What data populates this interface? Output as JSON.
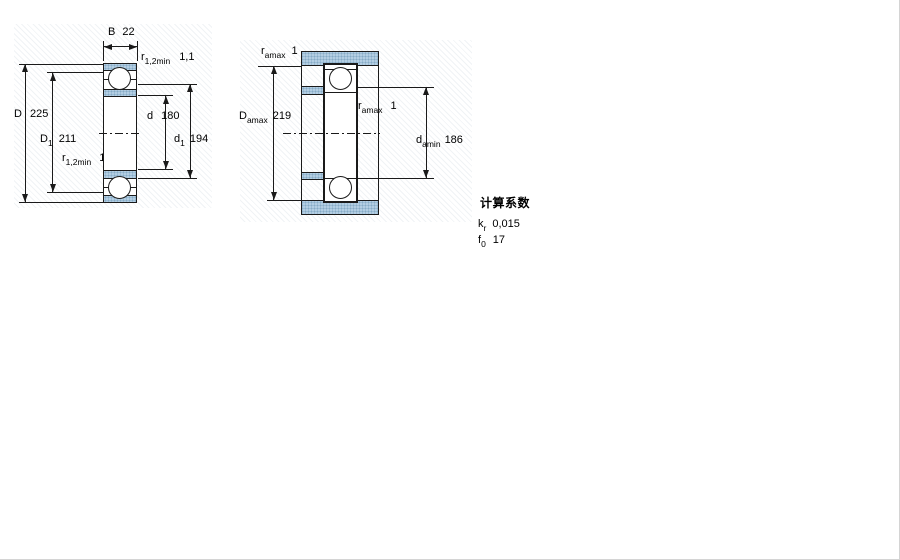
{
  "colors": {
    "shading": "#b3cee3",
    "shading_dot": "#86abc6",
    "line": "#1a1a1a"
  },
  "left_figure": {
    "description": "bearing cross-section",
    "b": {
      "name": "B",
      "sub": "",
      "value": "22"
    },
    "r_top": {
      "name": "r",
      "sub": "1,2min",
      "value": "1,1"
    },
    "D": {
      "name": "D",
      "sub": "",
      "value": "225"
    },
    "D1": {
      "name": "D",
      "sub": "1",
      "value": "211"
    },
    "r_bottom": {
      "name": "r",
      "sub": "1,2min",
      "value": "1,1"
    },
    "d": {
      "name": "d",
      "sub": "",
      "value": "180"
    },
    "d1": {
      "name": "d",
      "sub": "1",
      "value": "194"
    }
  },
  "right_figure": {
    "description": "abutment dimensions",
    "r_a_top": {
      "name": "r",
      "sub": "amax",
      "value": "1"
    },
    "D_a": {
      "name": "D",
      "sub": "amax",
      "value": "219"
    },
    "r_a_mid": {
      "name": "r",
      "sub": "amax",
      "value": "1"
    },
    "d_a": {
      "name": "d",
      "sub": "amin",
      "value": "186"
    }
  },
  "calculation_factors": {
    "title": "计算系数",
    "rows": [
      {
        "symbol": "k",
        "sub": "r",
        "value": "0,015"
      },
      {
        "symbol": "f",
        "sub": "0",
        "value": "17"
      }
    ]
  }
}
